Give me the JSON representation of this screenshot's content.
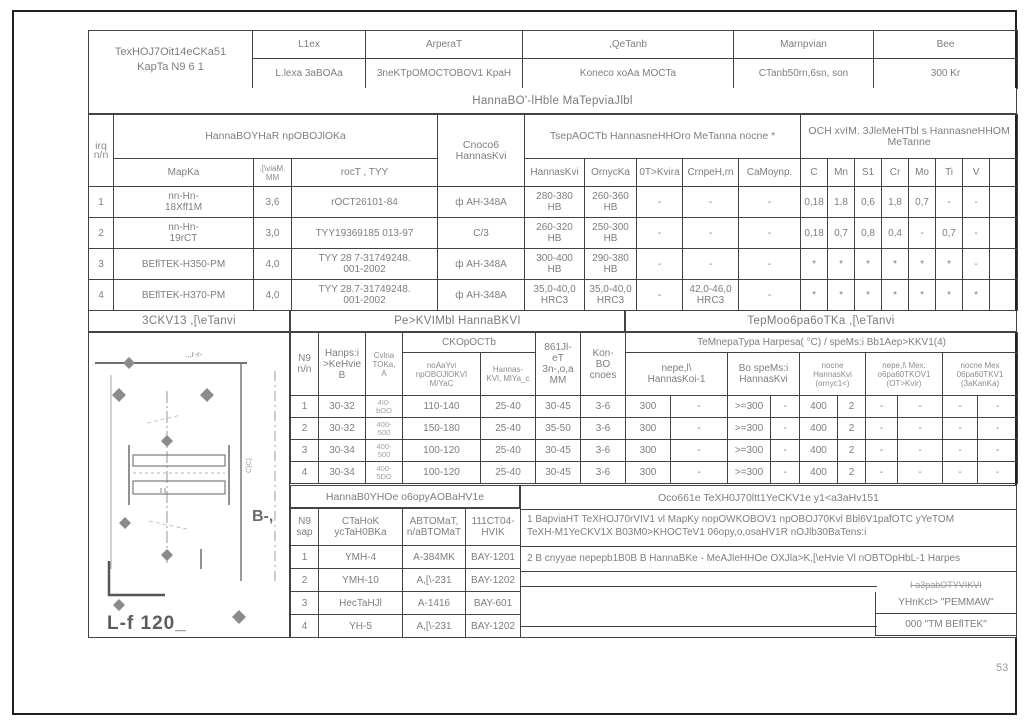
{
  "page": {
    "number": "53"
  },
  "colors": {
    "line": "#434343",
    "text": "#7e7e7e",
    "faint": "#9c9c9c"
  },
  "title_block": {
    "title": "TexHOJ7Oit14eCKa51\nKapTa N9 6 1",
    "cols": [
      {
        "header": "L1ex",
        "value": "L.lexa 3aBOAa"
      },
      {
        "header": "ArperaT",
        "value": "3neKTpOMOCTOBOV1 KpaH"
      },
      {
        "header": ",QeTanb",
        "value": "Koneco xoAa MOCTa"
      },
      {
        "header": "Marnpvian",
        "value": "CTanb50rn,6sn, son"
      },
      {
        "header": "Bee",
        "value": "300 Kr"
      }
    ]
  },
  "materials": {
    "band": "HannaBO'-lHble MaTepviaJlbl",
    "num_header": "irq\nn/n",
    "wire_group": "HannaBOYHaR npOBOJlOKa",
    "wire_cols": [
      "MapKa",
      ",[\\viaM.\nMM",
      "rocT , TYY"
    ],
    "method": "Cnoco6\nHannasKvi",
    "hardness_group": "TsepAOCTb HannasneHHOro MeTanna nocne *",
    "hardness_cols": [
      "HannasKvi",
      "OrnycKa",
      "0T>Kvira",
      "CrnpeH,rn",
      "CaMoynp."
    ],
    "chem_group": "OCH xvIM. 3JleMeHTbl s HannasneHHOM MeTanne",
    "chem_cols": [
      "C",
      "Mn",
      "S1",
      "Cr",
      "Mo",
      "Ti",
      "V",
      ""
    ],
    "rows": [
      [
        "1",
        "nn-Hn-\n18Xff1M",
        "3,6",
        "rOCT26101-84",
        "ф AH-348A",
        "280-380\nHB",
        "260-360\nHB",
        "-",
        "-",
        "-",
        "0,18",
        "1,8",
        "0,6",
        "1,8",
        "0,7",
        "-",
        "-",
        ""
      ],
      [
        "2",
        "nn-Hn-\n19rCT",
        "3,0",
        "TYY19369185 013-97",
        "C/3",
        "260-320\nHB",
        "250-300\nHB",
        "-",
        "-",
        "-",
        "0,18",
        "0,7",
        "0,8",
        "0,4",
        "-",
        "0,7",
        "-",
        ""
      ],
      [
        "3",
        "BEflTEK-H350-PM",
        "4,0",
        "TYY 28 7-31749248.\n001-2002",
        "ф AH-348A",
        "300-400\nHB",
        "290-380\nHB",
        "-",
        "-",
        "-",
        "*",
        "*",
        "*",
        "*",
        "*",
        "*",
        "-",
        ""
      ],
      [
        "4",
        "BEflTEK-H370-PM",
        "4,0",
        "TYY 28.7-31749248.\n001-2002",
        "ф AH-348A",
        "35,0-40,0\nHRC3",
        "35,0-40,0\nHRC3",
        "-",
        "42,0-46,0\nHRC3",
        "-",
        "*",
        "*",
        "*",
        "*",
        "*",
        "*",
        "*",
        ""
      ]
    ]
  },
  "modes": {
    "esk_band": "3CKV13 ,[\\eTanvi",
    "band": "Pe>KVIMbl HannaBKVI",
    "thermo_band": "TepMoo6pa6oTKa ,[\\eTanvi",
    "head": {
      "num": "N9\nn/n",
      "voltage": "Hanps:i\n>KeHvie\nB",
      "current": "Cvlna\nTOKa,\nA",
      "speed": "CKOpOCTb",
      "speed_feed": "noAaYvi\nnpOBOJlOKVI\nM/YaC",
      "speed_surf": "Hannas-\nKVl, MlYa_c",
      "electrode": "861Jl-\neT\n3n-,o,a\nMM",
      "layers": "Kon-\nBO\ncnoes",
      "temp": "TeMnepaTypa Harpesa( °C) / speMs:i Bb1Aep>KKV1(4)",
      "t1": "nepe,l\\\nHannasKoi-1",
      "t2": "Bo speMs:i\nHannasKvi",
      "t3": "nocne\nHannasKvi\n(ornyc1<)",
      "t4": "nepe,l\\ Mex.\no6pa60TKOV1\n(OT>Kvir)",
      "t5": "nocne Mex\n06pa60TKV1\n(3aKanKa)"
    },
    "rows": [
      [
        "1",
        "30-32",
        "4I0-\nbOO",
        "110-140",
        "25-40",
        "30-45",
        "3-6",
        "300",
        "-",
        ">=300",
        "-",
        "400",
        "2",
        "-",
        "-",
        "-",
        "-"
      ],
      [
        "2",
        "30-32",
        "400-\n500",
        "150-180",
        "25-40",
        "35-50",
        "3-6",
        "300",
        "-",
        ">=300",
        "-",
        "400",
        "2",
        "-",
        "-",
        "-",
        "-"
      ],
      [
        "3",
        "30-34",
        "400-\n500",
        "100-120",
        "25-40",
        "30-45",
        "3-6",
        "300",
        "-",
        ">=300",
        "-",
        "400",
        "2",
        "-",
        "-",
        "-",
        "-"
      ],
      [
        "4",
        "30-34",
        "400-\n5DO",
        "100-120",
        "25-40",
        "30-45",
        "3-6",
        "300",
        "-",
        ">=300",
        "-",
        "400",
        "2",
        "-",
        "-",
        "-",
        "-"
      ]
    ]
  },
  "equipment": {
    "band": "HannaB0YHOe o6opyAOBaHV1e",
    "head": [
      "N9\nsap",
      "CTaHoK\nycTaH0BKa",
      "ABTOMaT,\nn/aBTOMaT",
      "111CT04-\nHVIK"
    ],
    "rows": [
      [
        "1",
        "YMH-4",
        "A-384MK",
        "BAY-1201"
      ],
      [
        "2",
        "YMH-10",
        "A,[\\-231",
        "BAY-1202"
      ],
      [
        "3",
        "HecTaHJl",
        "A-1416",
        "BAY-601"
      ],
      [
        "4",
        "YH-5",
        "A,[\\-231",
        "BAY-1202"
      ]
    ]
  },
  "notes": {
    "title": "Oco661e TeXH0J70ltt1YeCKV1e y1<a3aHv151",
    "items": [
      "1 BapviaHT TeXHOJ70rVIV1 vl MapKy nopOWKOBOV1 npOBOJ70Kvl Bbl6V1pafOTC yYeTOM\nTeXH-M1YeCKV1X B03M0>KHOCTeV1 06opy,o,osaHV1R nOJlb30BaTens:i",
      "2 B cnyyae nepepb1B0B B HannaBKe - MeAJleHHOe OXJla>K,[\\eHvie Vl nOBTOpHbL-1 Harpes"
    ],
    "developers": {
      "header": "l-a3pabOTYVIKVI",
      "org1": "YHnKct> \"PEMMAW\"",
      "org2": "000    \"TM BEflTEK\""
    }
  },
  "sketch": {
    "section_label": "..,r-r-",
    "view_label": "B-,",
    "small_label": "C)C)",
    "dim_label": "L-f 120_"
  }
}
